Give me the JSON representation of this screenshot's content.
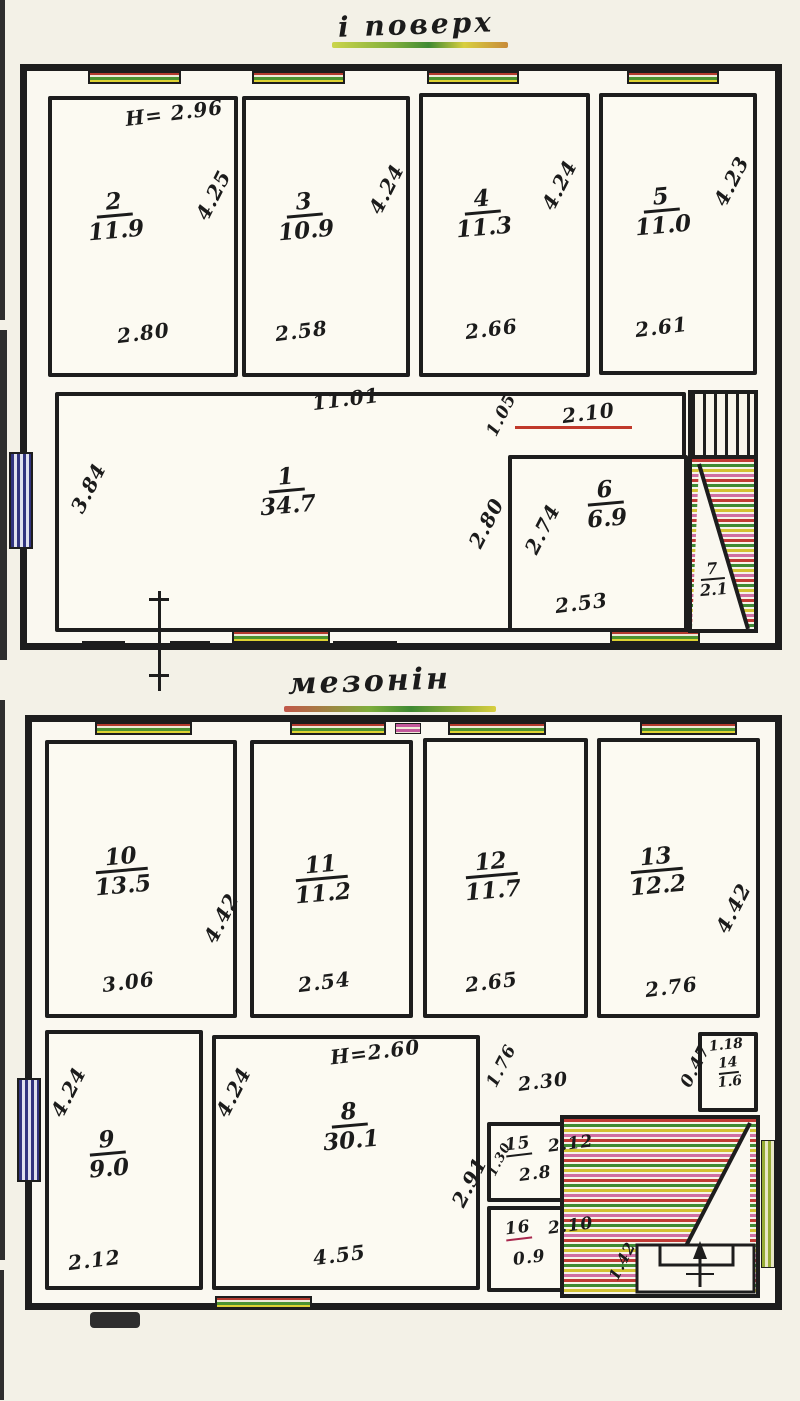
{
  "colors": {
    "ink": "#1d1d1d",
    "paper": "#faf8f0",
    "window_red": "#b33a2d",
    "window_green": "#4d9330",
    "window_yellow": "#ded232",
    "window_blue": "#31347f",
    "stair_pink": "#cf6fa2"
  },
  "floor1": {
    "title": "і поверх",
    "ceiling_height": "Н= 2.96",
    "rooms": {
      "r1": {
        "num": "1",
        "area": "34.7"
      },
      "r2": {
        "num": "2",
        "area": "11.9"
      },
      "r3": {
        "num": "3",
        "area": "10.9"
      },
      "r4": {
        "num": "4",
        "area": "11.3"
      },
      "r5": {
        "num": "5",
        "area": "11.0"
      },
      "r6": {
        "num": "6",
        "area": "6.9"
      },
      "r7": {
        "num": "7",
        "area": "2.1"
      }
    },
    "dims": {
      "r1_width": "11.01",
      "r1_left": "3.84",
      "r2_width": "2.80",
      "r2_height": "4.25",
      "r3_width": "2.58",
      "r3_height": "4.24",
      "r4_width": "2.66",
      "r4_height": "4.24",
      "r5_width": "2.61",
      "r5_height": "4.23",
      "r6_top": "2.10",
      "r6_left": "2.74",
      "r6_bottom": "2.53",
      "hall_right": "2.80",
      "nook": "1.05"
    }
  },
  "floor2": {
    "title": "мезонін",
    "ceiling_height": "Н=2.60",
    "rooms": {
      "r8": {
        "num": "8",
        "area": "30.1"
      },
      "r9": {
        "num": "9",
        "area": "9.0"
      },
      "r10": {
        "num": "10",
        "area": "13.5"
      },
      "r11": {
        "num": "11",
        "area": "11.2"
      },
      "r12": {
        "num": "12",
        "area": "11.7"
      },
      "r13": {
        "num": "13",
        "area": "12.2"
      },
      "r14": {
        "num": "14",
        "area": "1.6"
      },
      "r15": {
        "num": "15",
        "area": "2.8"
      },
      "r16": {
        "num": "16",
        "area": "0.9"
      }
    },
    "dims": {
      "r8_width": "4.55",
      "r8_height": "4.24",
      "r9_width": "2.12",
      "r9_height": "4.24",
      "r10_width": "3.06",
      "r10_height": "4.42",
      "r11_width": "2.54",
      "r12_width": "2.65",
      "r13_width": "2.76",
      "r13_height": "4.42",
      "r14_width": "1.18",
      "r15_width": "2.12",
      "r15_height": "1.30",
      "r16_width": "2.10",
      "stair_diag": "1.42",
      "hall_w1": "1.76",
      "hall_w2": "2.30",
      "hall_stub": "0.47",
      "hall_height": "2.91"
    }
  }
}
